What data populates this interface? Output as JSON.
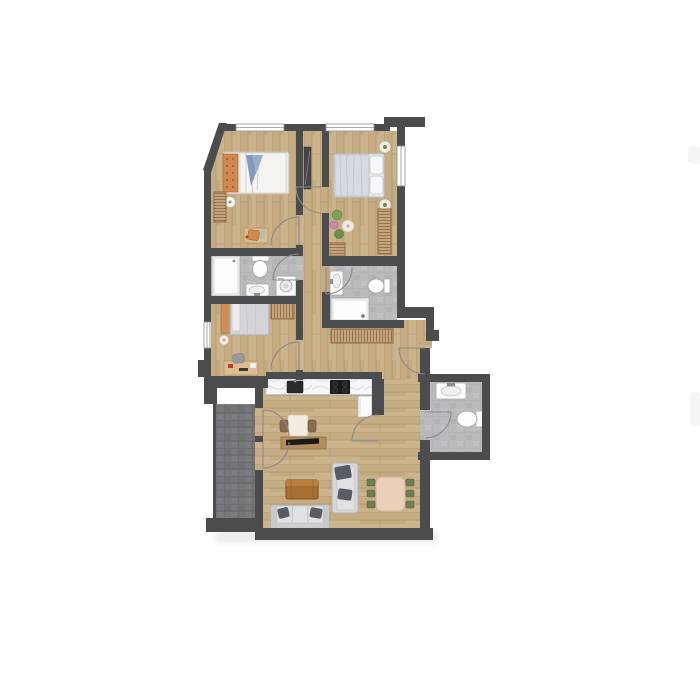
{
  "page": {
    "background": "#ffffff",
    "title": "Apartment floor plan"
  },
  "plan": {
    "title": "Apartment floor plan",
    "style": "top-down 2D architectural color rendering, no text labels",
    "colors": {
      "background": "#ffffff",
      "wall": "#4b4c4e",
      "wood_light": "#cbb38c",
      "wood_mid": "#c0a679",
      "wood_dark": "#b2966c",
      "wood_line": "#a98f66",
      "bath_tile": "#b9babc",
      "bath_tile_line": "#a8a9ab",
      "balcony_tile": "#76777a",
      "balcony_tile_line": "#5e5f62",
      "counter_marble": "#f6f6f8",
      "fixture_outline": "#a9abad",
      "door_arc": "#8a8a8a",
      "radiator_fill": "#c5a47b",
      "radiator_line": "#8b6a49",
      "bed_gray": "#d5dbe0",
      "accent_blue": "#7792b4",
      "accent_orange": "#cf8850",
      "sofa_gray": "#d6d7d9",
      "cushion_dark": "#585d63",
      "table_wood": "#a86f33",
      "dining_table": "#eacfba",
      "chair_green": "#6f7f53",
      "appliance_dark": "#1a1a1d"
    },
    "rooms": [
      {
        "id": "bedroom-1",
        "name": "Bedroom 1 (top left)",
        "floor": "wood",
        "features": [
          "double bed with orange and blue bedding",
          "round bedside table",
          "wall radiator",
          "desk with orange chair"
        ]
      },
      {
        "id": "bedroom-2",
        "name": "Bedroom 2 (top right)",
        "floor": "wood",
        "features": [
          "double bed with gray duvet and two pillows",
          "two round side tables",
          "radiator",
          "bench",
          "plant corner with small table"
        ]
      },
      {
        "id": "hallway",
        "name": "Hallway / corridor",
        "floor": "wood",
        "features": [
          "tall dark wardrobe"
        ]
      },
      {
        "id": "bathroom-1",
        "name": "Bathroom 1 (middle left)",
        "floor": "gray tile",
        "features": [
          "walk-in shower",
          "toilet",
          "washbasin",
          "washing machine"
        ]
      },
      {
        "id": "bedroom-3",
        "name": "Bedroom 3 (small, left)",
        "floor": "wood",
        "features": [
          "single bed",
          "radiator",
          "desk with chair",
          "round stool"
        ]
      },
      {
        "id": "bathroom-2",
        "name": "Bathroom 2 (center)",
        "floor": "gray tile",
        "features": [
          "washbasin",
          "toilet",
          "shower tray",
          "radiator below"
        ]
      },
      {
        "id": "kitchen",
        "name": "Kitchen nook",
        "floor": "wood",
        "features": [
          "counter with dark sink and cooktop",
          "tall white cabinet",
          "breakfast table with two wooden chairs",
          "sideboard with TV"
        ]
      },
      {
        "id": "living-dining",
        "name": "Living / dining room",
        "floor": "wood",
        "features": [
          "three-seat sofa with dark pillows",
          "chaise longue",
          "wooden coffee table",
          "dining table with six green chairs"
        ]
      },
      {
        "id": "wc",
        "name": "Guest WC (right)",
        "floor": "gray tile",
        "features": [
          "washbasin",
          "toilet"
        ]
      },
      {
        "id": "balcony",
        "name": "Balcony (left)",
        "floor": "dark tile",
        "features": [
          "two glass doors from living area"
        ]
      }
    ],
    "openings": {
      "windows": 4,
      "balcony_doors": 2,
      "entrance": "apartment entrance door on right side with swing arc"
    }
  }
}
